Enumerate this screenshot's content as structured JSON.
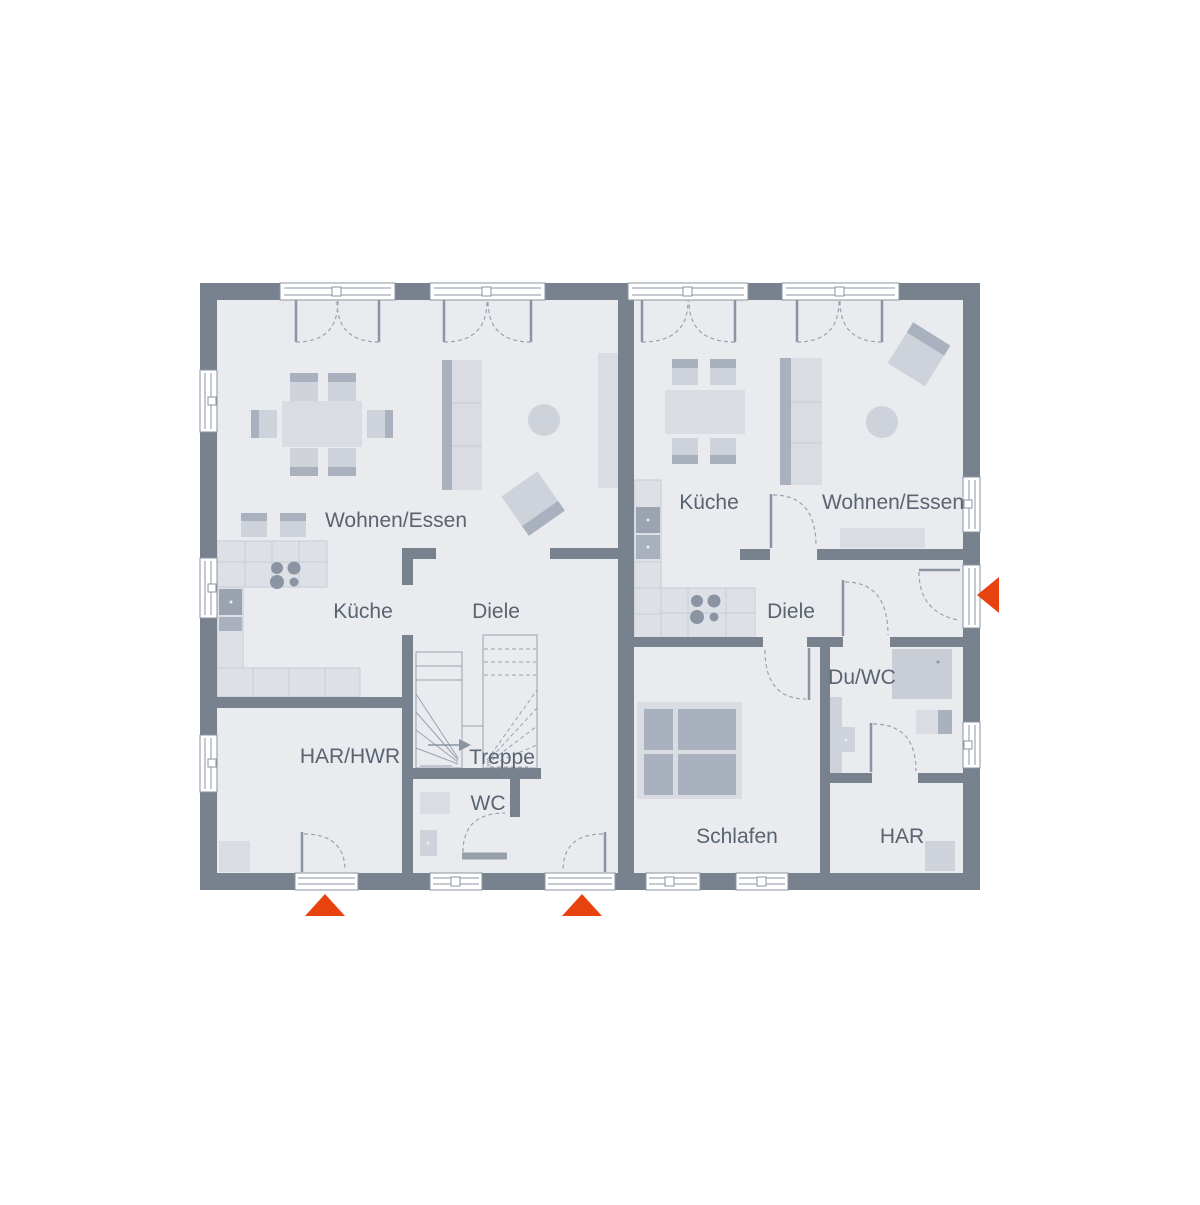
{
  "colors": {
    "wall": "#78828f",
    "floor": "#e9ebef",
    "accent": "#e8430f",
    "label": "#5a6370",
    "furniture_light": "#d9dce2",
    "furniture_dark": "#aab1be"
  },
  "plan": {
    "type": "floorplan-ground-floor-duplex",
    "units": [
      {
        "id": "unit-left",
        "rooms": [
          {
            "key": "wohnen_essen",
            "label": "Wohnen/Essen"
          },
          {
            "key": "kueche",
            "label": "Küche"
          },
          {
            "key": "diele",
            "label": "Diele"
          },
          {
            "key": "har_hwr",
            "label": "HAR/HWR"
          },
          {
            "key": "treppe",
            "label": "Treppe"
          },
          {
            "key": "wc",
            "label": "WC"
          }
        ]
      },
      {
        "id": "unit-right",
        "rooms": [
          {
            "key": "kueche",
            "label": "Küche"
          },
          {
            "key": "wohnen_essen",
            "label": "Wohnen/Essen"
          },
          {
            "key": "diele",
            "label": "Diele"
          },
          {
            "key": "du_wc",
            "label": "Du/WC"
          },
          {
            "key": "schlafen",
            "label": "Schlafen"
          },
          {
            "key": "har",
            "label": "HAR"
          }
        ]
      }
    ],
    "entrance_markers": [
      {
        "direction": "up",
        "unit": "unit-left"
      },
      {
        "direction": "up",
        "unit": "unit-left"
      },
      {
        "direction": "left",
        "unit": "unit-right"
      }
    ]
  }
}
